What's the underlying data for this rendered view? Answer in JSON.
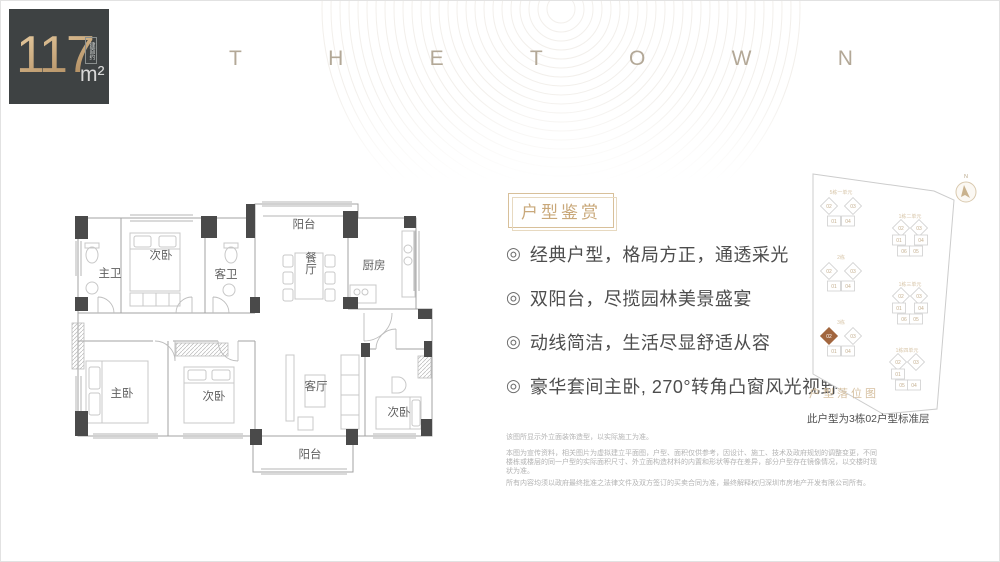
{
  "colors": {
    "accent": "#c8a97c",
    "highlight": "#a2663e",
    "wall": "#4a4a4a",
    "badge_bg": "#3e4243"
  },
  "badge": {
    "area_value": "117",
    "area_note": "建面约",
    "area_unit": "m²"
  },
  "brand": {
    "letters": [
      "T",
      "H",
      "E",
      "T",
      "O",
      "W",
      "N"
    ]
  },
  "floorplan": {
    "rooms": {
      "balcony_top": "阳台",
      "bedroom2": "次卧",
      "master_bath": "主卫",
      "guest_bath": "客卫",
      "dining": "餐厅",
      "kitchen": "厨房",
      "master_bedroom": "主卧",
      "bedroom3": "次卧",
      "living": "客厅",
      "bedroom4": "次卧",
      "balcony_bottom": "阳台"
    }
  },
  "features": {
    "title": "户型鉴赏",
    "bullet_icon": "◎",
    "items": [
      "经典户型，格局方正，通透采光",
      "双阳台，尽揽园林美景盛宴",
      "动线简洁，生活尽显舒适从容",
      "豪华套间主卧, 270°转角凸窗风光视野"
    ]
  },
  "siteplan": {
    "caption": "户型落位图",
    "note": "此户型为3栋02户型标准层",
    "compass_label": "N",
    "clusters": [
      {
        "label": "5栋一单元",
        "x": 47,
        "y": 42,
        "units": [
          {
            "no": "02",
            "dx": -12,
            "dy": -2,
            "shape": "diamond"
          },
          {
            "no": "03",
            "dx": 12,
            "dy": -2,
            "shape": "diamond"
          },
          {
            "no": "01",
            "dx": -7,
            "dy": 13,
            "shape": "rect"
          },
          {
            "no": "04",
            "dx": 7,
            "dy": 13,
            "shape": "rect"
          }
        ]
      },
      {
        "label": "2栋",
        "x": 47,
        "y": 107,
        "units": [
          {
            "no": "02",
            "dx": -12,
            "dy": -2,
            "shape": "diamond"
          },
          {
            "no": "03",
            "dx": 12,
            "dy": -2,
            "shape": "diamond"
          },
          {
            "no": "01",
            "dx": -7,
            "dy": 13,
            "shape": "rect"
          },
          {
            "no": "04",
            "dx": 7,
            "dy": 13,
            "shape": "rect"
          }
        ]
      },
      {
        "label": "3栋",
        "x": 47,
        "y": 172,
        "units": [
          {
            "no": "02",
            "dx": -12,
            "dy": -2,
            "shape": "diamond",
            "highlight": true
          },
          {
            "no": "03",
            "dx": 12,
            "dy": -2,
            "shape": "diamond"
          },
          {
            "no": "01",
            "dx": -7,
            "dy": 13,
            "shape": "rect"
          },
          {
            "no": "04",
            "dx": 7,
            "dy": 13,
            "shape": "rect"
          }
        ]
      },
      {
        "label": "1栋二单元",
        "x": 116,
        "y": 66,
        "units": [
          {
            "no": "02",
            "dx": -9,
            "dy": -4,
            "shape": "diamond"
          },
          {
            "no": "03",
            "dx": 9,
            "dy": -4,
            "shape": "diamond"
          },
          {
            "no": "01",
            "dx": -11,
            "dy": 8,
            "shape": "rect"
          },
          {
            "no": "04",
            "dx": 11,
            "dy": 8,
            "shape": "rect"
          },
          {
            "no": "06",
            "dx": -6,
            "dy": 19,
            "shape": "rect"
          },
          {
            "no": "05",
            "dx": 6,
            "dy": 19,
            "shape": "rect"
          }
        ]
      },
      {
        "label": "1栋三单元",
        "x": 116,
        "y": 134,
        "units": [
          {
            "no": "02",
            "dx": -9,
            "dy": -4,
            "shape": "diamond"
          },
          {
            "no": "03",
            "dx": 9,
            "dy": -4,
            "shape": "diamond"
          },
          {
            "no": "01",
            "dx": -11,
            "dy": 8,
            "shape": "rect"
          },
          {
            "no": "04",
            "dx": 11,
            "dy": 8,
            "shape": "rect"
          },
          {
            "no": "06",
            "dx": -6,
            "dy": 19,
            "shape": "rect"
          },
          {
            "no": "05",
            "dx": 6,
            "dy": 19,
            "shape": "rect"
          }
        ]
      },
      {
        "label": "1栋四单元",
        "x": 113,
        "y": 200,
        "units": [
          {
            "no": "02",
            "dx": -9,
            "dy": -4,
            "shape": "diamond"
          },
          {
            "no": "03",
            "dx": 9,
            "dy": -4,
            "shape": "diamond"
          },
          {
            "no": "01",
            "dx": -9,
            "dy": 8,
            "shape": "rect"
          },
          {
            "no": "05",
            "dx": -5,
            "dy": 19,
            "shape": "rect"
          },
          {
            "no": "04",
            "dx": 7,
            "dy": 19,
            "shape": "rect"
          }
        ]
      }
    ]
  },
  "disclaimer": {
    "line1": "该图所显示外立面装饰造型，以实际施工为准。",
    "para": "本图为宣传资料，相关图片为虚拟建立平面图，户型、面积仅供参考，因设计、施工、技术及政府规划的调整变更，不同楼栋或楼层的同一户型的实际面积尺寸、外立面构造材料的内置和形状等存在差异，部分户型存在镜像情况，以交楼时现状为准。",
    "line3": "所有内容均须以政府最终批准之法律文件及双方签订的买卖合同为准，最终解释权归深圳市房地产开发有限公司所有。"
  }
}
